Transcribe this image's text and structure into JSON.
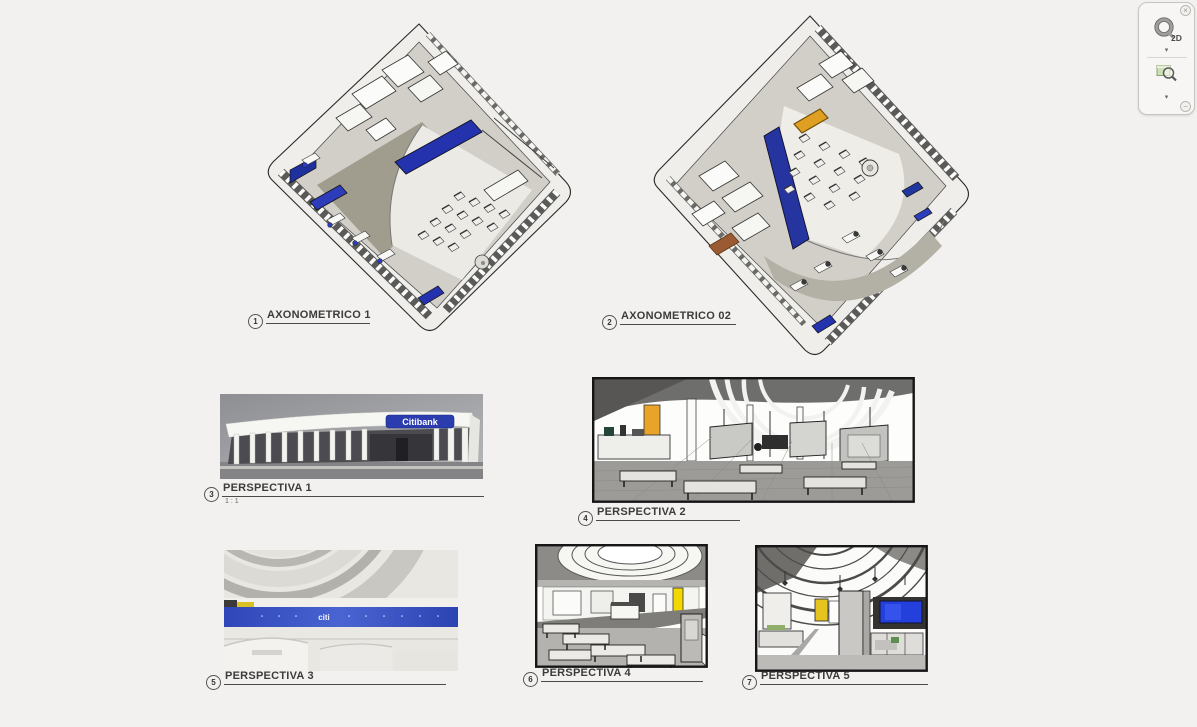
{
  "app": {
    "background_color": "#f2f1ef"
  },
  "navigation_bar": {
    "close_glyph": "×",
    "collapse_glyph": "−",
    "caret_glyph": "▾",
    "wheel_icon": "steering-wheel-2d-icon",
    "wheel_badge": "2D",
    "zoom_icon": "zoom-region-icon"
  },
  "sheet": {
    "views": [
      {
        "number": "1",
        "label": "AXONOMETRICO 1",
        "type": "axonometric"
      },
      {
        "number": "2",
        "label": "AXONOMETRICO 02",
        "type": "axonometric"
      },
      {
        "number": "3",
        "label": "PERSPECTIVA 1",
        "scale": "1 : 1",
        "type": "perspective-exterior"
      },
      {
        "number": "4",
        "label": "PERSPECTIVA 2",
        "type": "perspective-interior"
      },
      {
        "number": "5",
        "label": "PERSPECTIVA 3",
        "type": "perspective-interior-render"
      },
      {
        "number": "6",
        "label": "PERSPECTIVA 4",
        "type": "perspective-interior"
      },
      {
        "number": "7",
        "label": "PERSPECTIVA 5",
        "type": "perspective-interior"
      }
    ],
    "signs": {
      "citibank": "Citibank",
      "citi": "citi"
    },
    "colors": {
      "counter_blue": "#2433ad",
      "citi_band_blue": "#3a53c4",
      "accent_yellow": "#e0c022",
      "accent_orange": "#e2a226",
      "floor_olive": "#a09d8e",
      "floor_gray": "#9c9b97"
    }
  }
}
